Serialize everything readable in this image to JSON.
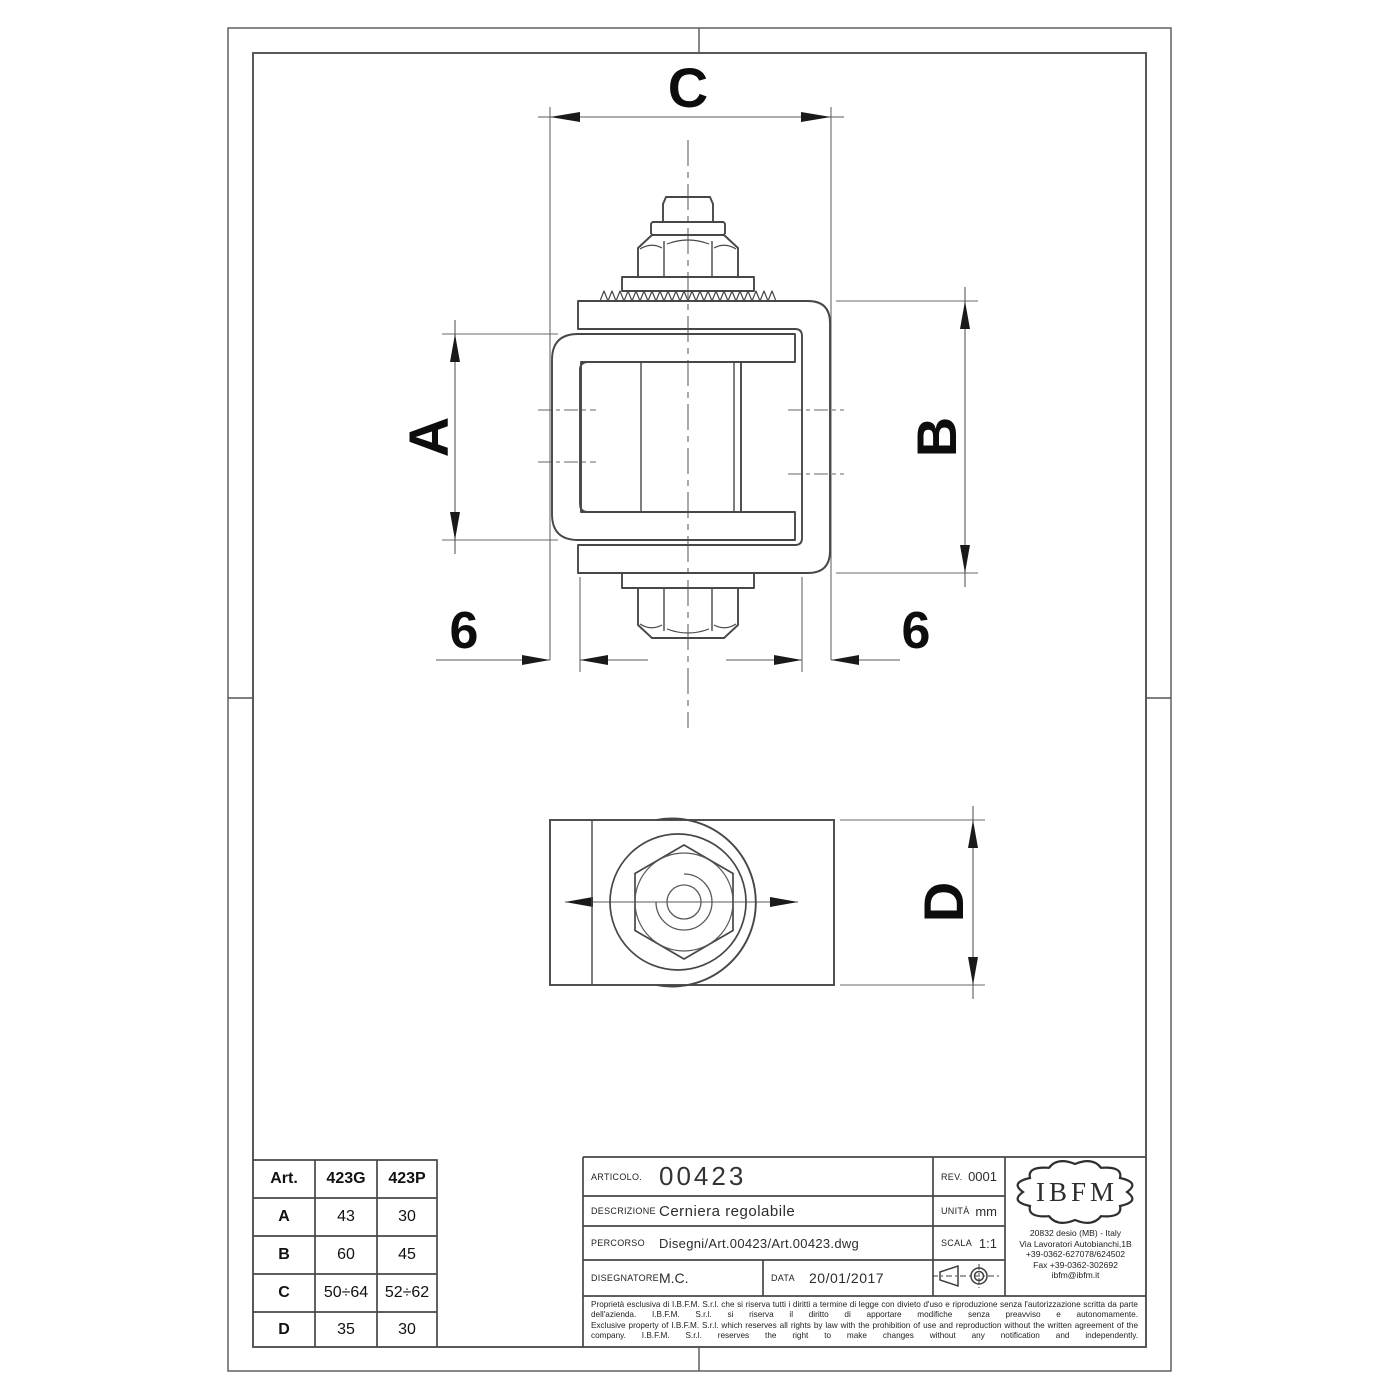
{
  "drawing": {
    "dim_top": "C",
    "dim_left": "A",
    "dim_right": "B",
    "dim_gap_left": "6",
    "dim_gap_right": "6",
    "dim_plan": "D"
  },
  "spec_table": {
    "headers": [
      "Art.",
      "423G",
      "423P"
    ],
    "rows": [
      [
        "A",
        "43",
        "30"
      ],
      [
        "B",
        "60",
        "45"
      ],
      [
        "C",
        "50÷64",
        "52÷62"
      ],
      [
        "D",
        "35",
        "30"
      ]
    ]
  },
  "title_block": {
    "articolo_label": "ARTICOLO.",
    "articolo": "00423",
    "rev_label": "REV.",
    "rev": "0001",
    "descrizione_label": "DESCRIZIONE",
    "descrizione": "Cerniera regolabile",
    "unita_label": "UNITÀ",
    "unita": "mm",
    "percorso_label": "PERCORSO",
    "percorso": "Disegni/Art.00423/Art.00423.dwg",
    "scala_label": "SCALA",
    "scala": "1:1",
    "disegnatore_label": "DISEGNATORE",
    "disegnatore": "M.C.",
    "data_label": "DATA",
    "data": "20/01/2017",
    "legal_it": "Proprietà esclusiva di I.B.F.M. S.r.l. che si riserva tutti i diritti a termine di legge con divieto d'uso e riproduzione senza l'autorizzazione scritta da parte dell'azienda. I.B.F.M. S.r.l. si riserva il diritto di apportare modifiche senza preavviso e autonomamente.",
    "legal_en": "Exclusive property of I.B.F.M. S.r.l. which reserves all rights by law with the prohibition of use and reproduction without the written agreement of the company. I.B.F.M. S.r.l. reserves the right to make changes without any notification and independently."
  },
  "logo": {
    "name": "IBFM",
    "address_lines": [
      "20832 desio (MB) - Italy",
      "Via Lavoratori Autobianchi,1B",
      "+39-0362-627078/624502",
      "Fax +39-0362-302692",
      "ibfm@ibfm.it"
    ]
  }
}
